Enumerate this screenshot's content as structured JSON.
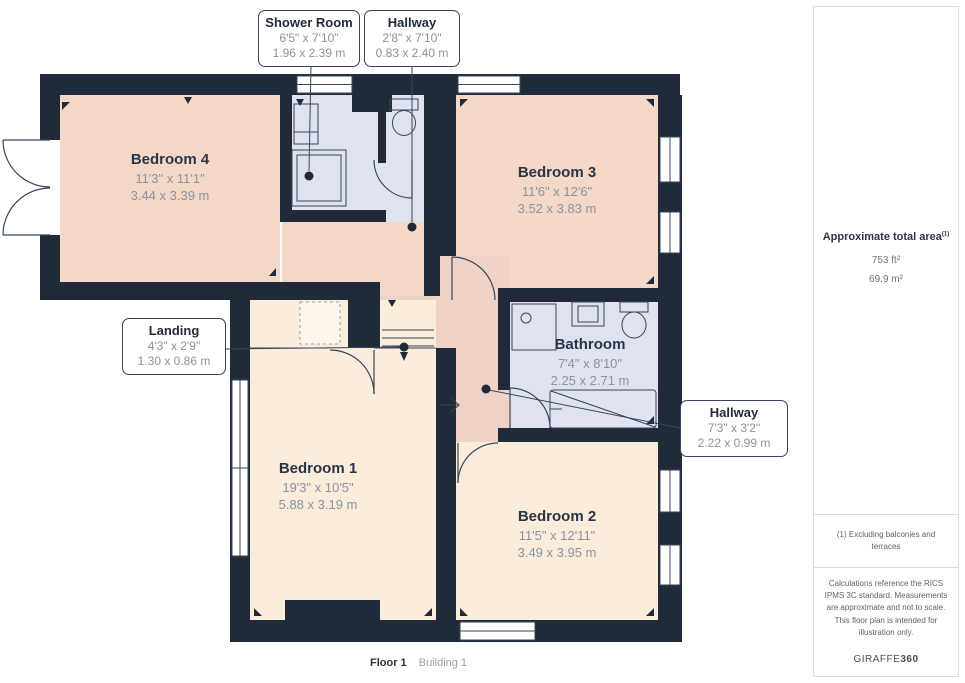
{
  "plan": {
    "rooms": {
      "bedroom4": {
        "name": "Bedroom 4",
        "imperial": "11'3\" x 11'1\"",
        "metric": "3.44 x 3.39 m"
      },
      "bedroom3": {
        "name": "Bedroom 3",
        "imperial": "11'6\" x 12'6\"",
        "metric": "3.52 x 3.83 m"
      },
      "bedroom1": {
        "name": "Bedroom 1",
        "imperial": "19'3\" x 10'5\"",
        "metric": "5.88 x 3.19 m"
      },
      "bedroom2": {
        "name": "Bedroom 2",
        "imperial": "11'5\" x 12'11\"",
        "metric": "3.49 x 3.95 m"
      },
      "bathroom": {
        "name": "Bathroom",
        "imperial": "7'4\" x 8'10\"",
        "metric": "2.25 x 2.71 m"
      }
    },
    "callouts": {
      "shower_room": {
        "name": "Shower Room",
        "imperial": "6'5\" x 7'10\"",
        "metric": "1.96 x 2.39 m"
      },
      "hallway_top": {
        "name": "Hallway",
        "imperial": "2'8\" x 7'10\"",
        "metric": "0.83 x 2.40 m"
      },
      "landing": {
        "name": "Landing",
        "imperial": "4'3\" x 2'9\"",
        "metric": "1.30 x 0.86 m"
      },
      "hallway_right": {
        "name": "Hallway",
        "imperial": "7'3\" x 3'2\"",
        "metric": "2.22 x 0.99 m"
      }
    },
    "footer": {
      "floor": "Floor 1",
      "building": "Building 1"
    }
  },
  "sidebar": {
    "total_area_label": "Approximate total area",
    "total_area_note_ref": "(1)",
    "area_imperial": "753 ft²",
    "area_metric": "69.9 m²",
    "footnote": "(1) Excluding balconies and terraces",
    "disclaimer": "Calculations reference the RICS IPMS 3C standard. Measurements are approximate and not to scale. This floor plan is intended for illustration only.",
    "brand_name": "GIRAFFE",
    "brand_suffix": "360"
  },
  "colors": {
    "wall": "#212a39",
    "bedroom_peach": "#f4d8c7",
    "bedroom_cream": "#fbeddb",
    "hallway_peach": "#eed3c6",
    "wet_room_blue": "#dee3ef",
    "line": "#39455a"
  }
}
